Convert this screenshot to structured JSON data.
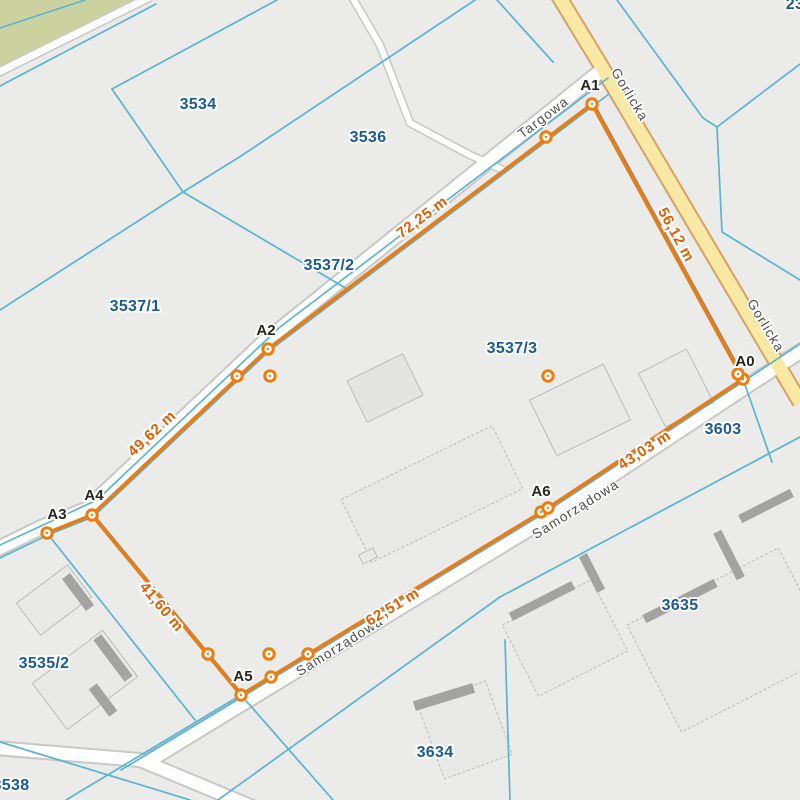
{
  "map": {
    "background": "#ebebe9",
    "green_area": {
      "fill": "#ccd1a0",
      "points": [
        [
          0,
          0
        ],
        [
          148,
          0
        ],
        [
          0,
          75
        ]
      ]
    },
    "teal": {
      "color": "#5ab4d2",
      "width": 1.7,
      "lines": [
        [
          [
            0,
            28
          ],
          [
            85,
            0
          ]
        ],
        [
          [
            0,
            86
          ],
          [
            156,
            4
          ]
        ],
        [
          [
            112,
            89
          ],
          [
            277,
            0
          ]
        ],
        [
          [
            112,
            89
          ],
          [
            183,
            192
          ]
        ],
        [
          [
            183,
            192
          ],
          [
            347,
            289
          ]
        ],
        [
          [
            183,
            192
          ],
          [
            0,
            310
          ]
        ],
        [
          [
            183,
            192
          ],
          [
            241,
            156
          ],
          [
            475,
            0
          ]
        ],
        [
          [
            497,
            0
          ],
          [
            553,
            62
          ]
        ],
        [
          [
            617,
            0
          ],
          [
            703,
            118
          ],
          [
            717,
            127
          ]
        ],
        [
          [
            717,
            127
          ],
          [
            800,
            64
          ]
        ],
        [
          [
            717,
            127
          ],
          [
            722,
            232
          ],
          [
            800,
            280
          ]
        ],
        [
          [
            608,
            78
          ],
          [
            280,
            327
          ],
          [
            97,
            500
          ],
          [
            0,
            545
          ]
        ],
        [
          [
            800,
            437
          ],
          [
            500,
            597
          ],
          [
            218,
            800
          ]
        ],
        [
          [
            241,
            695
          ],
          [
            66,
            800
          ]
        ],
        [
          [
            241,
            695
          ],
          [
            333,
            800
          ]
        ],
        [
          [
            47,
            533
          ],
          [
            195,
            720
          ]
        ],
        [
          [
            800,
            344
          ],
          [
            744,
            381
          ],
          [
            546,
            512
          ],
          [
            242,
            697
          ],
          [
            121,
            770
          ]
        ],
        [
          [
            743,
            379
          ],
          [
            772,
            462
          ]
        ],
        [
          [
            505,
            640
          ],
          [
            510,
            800
          ]
        ],
        [
          [
            0,
            742
          ],
          [
            190,
            800
          ]
        ],
        [
          [
            609,
            94
          ],
          [
            593,
            106
          ],
          [
            269,
            351
          ],
          [
            93,
            517
          ],
          [
            48,
            535
          ],
          [
            0,
            558
          ]
        ]
      ]
    },
    "roads": [
      {
        "name": "road-targowa",
        "points": [
          [
            602,
            70
          ],
          [
            263,
            343
          ],
          [
            87,
            509
          ],
          [
            42,
            527
          ],
          [
            -5,
            550
          ]
        ],
        "width": 13,
        "casing_width": 17,
        "fill": "#ffffff",
        "casing": "#c8c8c6"
      },
      {
        "name": "road-top-left",
        "points": [
          [
            150,
            -3
          ],
          [
            -3,
            73
          ]
        ],
        "width": 7,
        "casing_width": 10,
        "fill": "#ffffff",
        "casing": "#c8c8c6"
      },
      {
        "name": "road-north-lane",
        "points": [
          [
            352,
            -3
          ],
          [
            380,
            45
          ],
          [
            410,
            123
          ],
          [
            470,
            155
          ],
          [
            503,
            170
          ]
        ],
        "width": 6,
        "casing_width": 9,
        "fill": "#ffffff",
        "casing": "#c8c8c6"
      },
      {
        "name": "road-samorzadowa",
        "points": [
          [
            804,
            349
          ],
          [
            747,
            386
          ],
          [
            549,
            517
          ],
          [
            245,
            702
          ],
          [
            150,
            760
          ]
        ],
        "width": 13,
        "casing_width": 17,
        "fill": "#ffffff",
        "casing": "#c8c8c6"
      },
      {
        "name": "road-bottom-left",
        "points": [
          [
            -5,
            748
          ],
          [
            140,
            760
          ],
          [
            320,
            835
          ]
        ],
        "width": 12,
        "casing_width": 16,
        "fill": "#ffffff",
        "casing": "#c8c8c6"
      },
      {
        "name": "road-gorlicka",
        "points": [
          [
            558,
            -5
          ],
          [
            600,
            64
          ],
          [
            800,
            402
          ]
        ],
        "width": 13,
        "casing_width": 17,
        "fill": "#f9e9a4",
        "casing": "#d7a263"
      }
    ],
    "street_labels": [
      {
        "text": "Targowa",
        "x": 546,
        "y": 121,
        "rot": -37
      },
      {
        "text": "Gorlicka",
        "x": 626,
        "y": 97,
        "rot": 59
      },
      {
        "text": "Gorlicka",
        "x": 762,
        "y": 328,
        "rot": 59
      },
      {
        "text": "Samorządowa",
        "x": 578,
        "y": 513,
        "rot": -32
      },
      {
        "text": "Samorządowa",
        "x": 342,
        "y": 650,
        "rot": -32
      }
    ],
    "buildings": {
      "fill": "#e9e9e7",
      "stroke": "#bcbcba",
      "bar_color": "#a3a3a1",
      "items": [
        {
          "cx": 54,
          "cy": 600,
          "w": 64,
          "h": 40,
          "rot": -37,
          "dash": false
        },
        {
          "cx": 85,
          "cy": 680,
          "w": 88,
          "h": 58,
          "rot": -37,
          "dash": false
        },
        {
          "cx": 385,
          "cy": 388,
          "w": 62,
          "h": 46,
          "rot": -26,
          "dash": false,
          "fill": "#e4e4e1"
        },
        {
          "cx": 580,
          "cy": 410,
          "w": 82,
          "h": 62,
          "rot": -26,
          "dash": false
        },
        {
          "cx": 432,
          "cy": 494,
          "w": 168,
          "h": 70,
          "rot": -26,
          "dash": true
        },
        {
          "cx": 368,
          "cy": 556,
          "w": 16,
          "h": 10,
          "rot": -26,
          "dash": false
        },
        {
          "cx": 676,
          "cy": 388,
          "w": 54,
          "h": 60,
          "rot": -27,
          "dash": false
        },
        {
          "cx": 565,
          "cy": 638,
          "w": 100,
          "h": 80,
          "rot": -27,
          "dash": true
        },
        {
          "cx": 730,
          "cy": 640,
          "w": 170,
          "h": 120,
          "rot": -27,
          "dash": true
        },
        {
          "cx": 465,
          "cy": 730,
          "w": 72,
          "h": 78,
          "rot": -20,
          "dash": true
        }
      ],
      "bars": [
        {
          "cx": 78,
          "cy": 592,
          "w": 10,
          "h": 40,
          "rot": -37
        },
        {
          "cx": 113,
          "cy": 658,
          "w": 10,
          "h": 52,
          "rot": -37
        },
        {
          "cx": 103,
          "cy": 700,
          "w": 10,
          "h": 34,
          "rot": -37
        },
        {
          "cx": 542,
          "cy": 601,
          "w": 70,
          "h": 9,
          "rot": -27
        },
        {
          "cx": 592,
          "cy": 573,
          "w": 9,
          "h": 40,
          "rot": -27
        },
        {
          "cx": 680,
          "cy": 601,
          "w": 80,
          "h": 9,
          "rot": -27
        },
        {
          "cx": 729,
          "cy": 555,
          "w": 9,
          "h": 52,
          "rot": -27
        },
        {
          "cx": 766,
          "cy": 506,
          "w": 58,
          "h": 9,
          "rot": -27
        },
        {
          "cx": 444,
          "cy": 697,
          "w": 62,
          "h": 10,
          "rot": -17
        }
      ]
    },
    "measurement": {
      "line_color": "#e87d15",
      "line_width": 3.6,
      "shadow_color": "#8b8b80",
      "shadow_width": 2.2,
      "ring_color": "#ee7d0e",
      "loop": [
        [
          743,
          379
        ],
        [
          592,
          104
        ],
        [
          268,
          349
        ],
        [
          92,
          515
        ],
        [
          241,
          695
        ],
        [
          545,
          510
        ],
        [
          743,
          379
        ]
      ],
      "spur": [
        [
          92,
          515
        ],
        [
          47,
          533
        ]
      ],
      "shadow_segments": [
        [
          [
            594.5,
            105
          ],
          [
            745.5,
            380
          ]
        ],
        [
          [
            94.5,
            516
          ],
          [
            243.5,
            696
          ]
        ]
      ],
      "markers": [
        [
          743,
          379
        ],
        [
          738,
          374
        ],
        [
          592,
          104
        ],
        [
          546,
          137
        ],
        [
          268,
          349
        ],
        [
          237,
          376
        ],
        [
          270,
          376
        ],
        [
          92,
          515
        ],
        [
          47,
          533
        ],
        [
          208,
          654
        ],
        [
          269,
          654
        ],
        [
          271,
          677
        ],
        [
          241,
          695
        ],
        [
          308,
          654
        ],
        [
          541,
          512
        ],
        [
          548,
          508
        ],
        [
          548,
          376
        ]
      ],
      "vertex_labels": [
        {
          "text": "A0",
          "x": 745,
          "y": 366
        },
        {
          "text": "A1",
          "x": 590,
          "y": 90
        },
        {
          "text": "A2",
          "x": 266,
          "y": 335
        },
        {
          "text": "A3",
          "x": 57,
          "y": 519
        },
        {
          "text": "A4",
          "x": 94,
          "y": 500
        },
        {
          "text": "A5",
          "x": 243,
          "y": 681
        },
        {
          "text": "A6",
          "x": 541,
          "y": 496
        }
      ],
      "distance_labels": [
        {
          "text": "72,25 m",
          "x": 425,
          "y": 221,
          "rot": -37
        },
        {
          "text": "56,12 m",
          "x": 672,
          "y": 237,
          "rot": 61
        },
        {
          "text": "49,62 m",
          "x": 155,
          "y": 437,
          "rot": -43
        },
        {
          "text": "41,60 m",
          "x": 158,
          "y": 610,
          "rot": 50
        },
        {
          "text": "62,51 m",
          "x": 395,
          "y": 611,
          "rot": -31
        },
        {
          "text": "43,03 m",
          "x": 647,
          "y": 454,
          "rot": -33
        }
      ]
    },
    "parcel_labels": {
      "color": "#1a5a96",
      "items": [
        {
          "text": "3534",
          "x": 198,
          "y": 109
        },
        {
          "text": "3536",
          "x": 368,
          "y": 142
        },
        {
          "text": "3537/2",
          "x": 329,
          "y": 270
        },
        {
          "text": "3537/1",
          "x": 135,
          "y": 311
        },
        {
          "text": "3537/3",
          "x": 512,
          "y": 353
        },
        {
          "text": "3603",
          "x": 723,
          "y": 434
        },
        {
          "text": "3635",
          "x": 680,
          "y": 610
        },
        {
          "text": "3634",
          "x": 435,
          "y": 757
        },
        {
          "text": "3535/2",
          "x": 44,
          "y": 668
        },
        {
          "text": "3538",
          "x": 11,
          "y": 790
        },
        {
          "text": "23",
          "x": 795,
          "y": 9
        }
      ]
    }
  }
}
